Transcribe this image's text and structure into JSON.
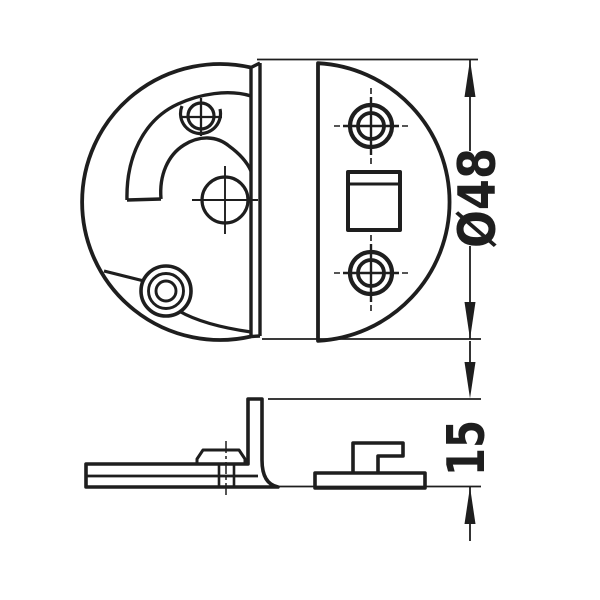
{
  "canvas": {
    "width": 600,
    "height": 600,
    "background": "#ffffff",
    "line_color": "#1e1e1e"
  },
  "drawing": {
    "type": "technical-line-drawing",
    "views": [
      {
        "id": "top-view",
        "parts": [
          "circular base plate with curved guide slot, guide screw, centre pivot hole and corner bushing",
          "half-round cover plate with two cross screws and square opening"
        ]
      },
      {
        "id": "side-view",
        "parts": [
          "L-shaped mounting bracket with rivet boss",
          "flat mounting plate with hook tab"
        ]
      }
    ],
    "dimensions": [
      {
        "id": "diameter",
        "label": "Ø48",
        "value": 48,
        "kind": "diameter",
        "orientation": "vertical"
      },
      {
        "id": "height",
        "label": "15",
        "value": 15,
        "kind": "linear",
        "orientation": "vertical"
      }
    ]
  }
}
